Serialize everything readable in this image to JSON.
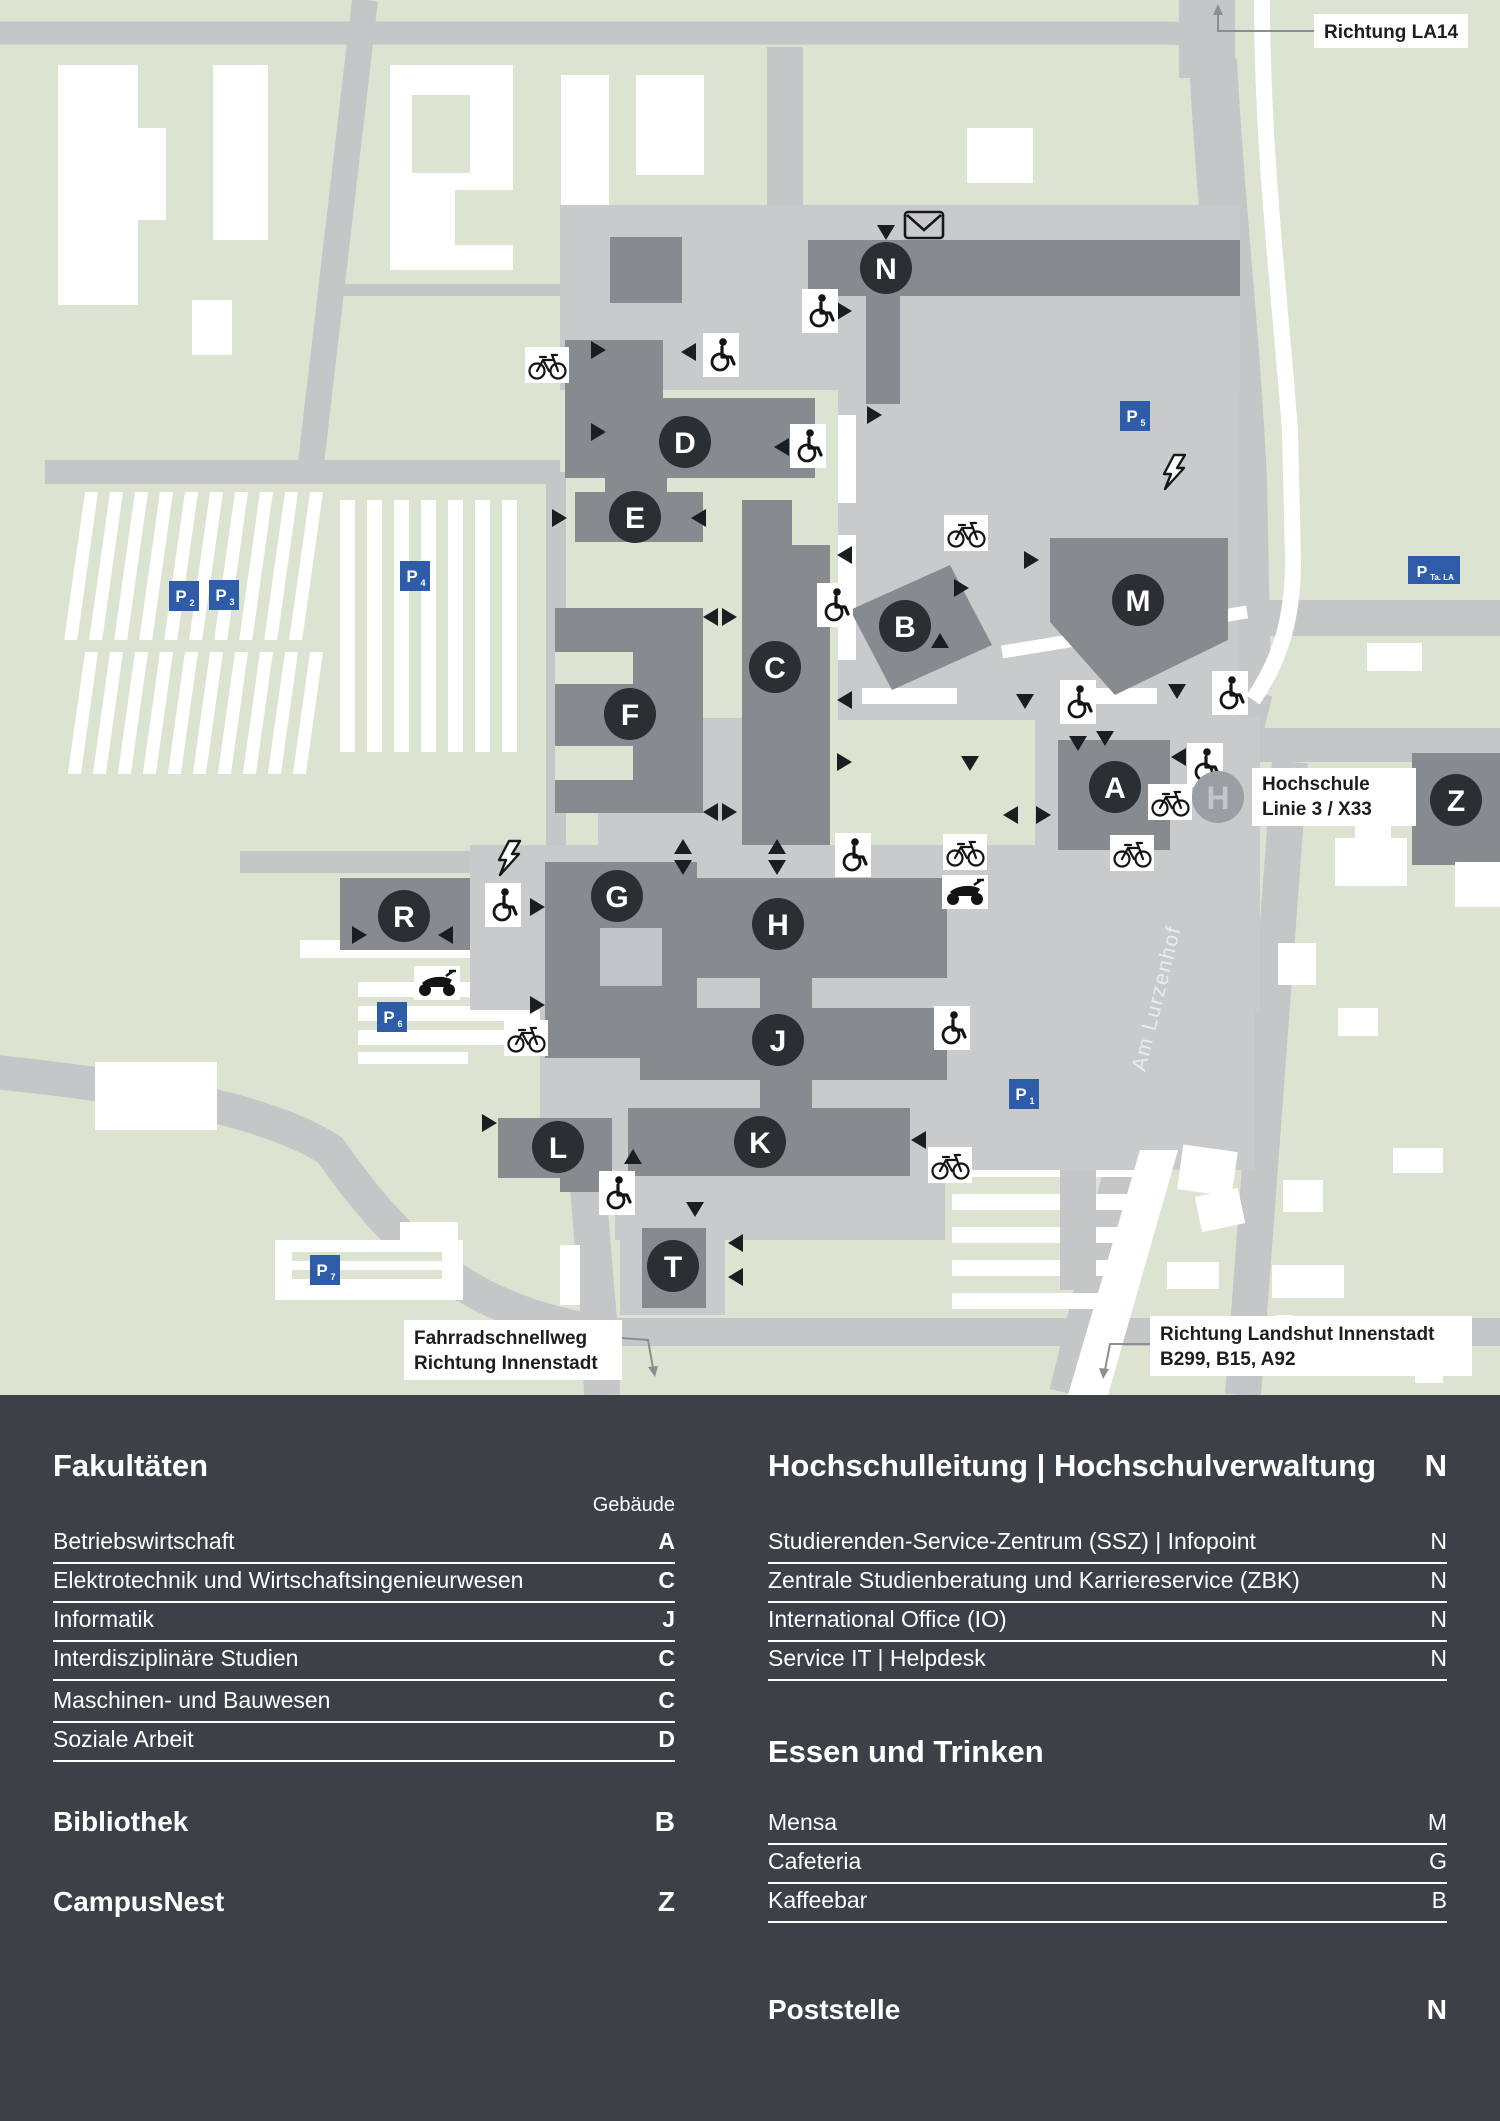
{
  "map": {
    "building_letters": [
      "N",
      "D",
      "E",
      "B",
      "C",
      "F",
      "M",
      "A",
      "Z",
      "R",
      "G",
      "H",
      "J",
      "K",
      "L",
      "T"
    ],
    "parking_signs": [
      {
        "p": "P",
        "sub": "1"
      },
      {
        "p": "P",
        "sub": "2"
      },
      {
        "p": "P",
        "sub": "3"
      },
      {
        "p": "P",
        "sub": "4"
      },
      {
        "p": "P",
        "sub": "5"
      },
      {
        "p": "P",
        "sub": "6"
      },
      {
        "p": "P",
        "sub": "7"
      },
      {
        "p": "P",
        "sub": "Ta. LA"
      }
    ],
    "bus_stop": {
      "symbol": "H",
      "label_line1": "Hochschule",
      "label_line2": "Linie 3 / X33"
    },
    "labels": {
      "top_right": "Richtung LA14",
      "street": "Am Lurzenhof",
      "bottom_left_line1": "Fahrradschnellweg",
      "bottom_left_line2": "Richtung Innenstadt",
      "bottom_right_line1": "Richtung Landshut Innenstadt",
      "bottom_right_line2": "B299, B15, A92"
    }
  },
  "legend": {
    "left": {
      "title": "Fakultäten",
      "column_note": "Gebäude",
      "rows": [
        {
          "label": "Betriebswirtschaft",
          "code": "A"
        },
        {
          "label": "Elektrotechnik und Wirtschaftsingenieurwesen",
          "code": "C"
        },
        {
          "label": "Informatik",
          "code": "J"
        },
        {
          "label": "Interdisziplinäre Studien",
          "code": "C"
        },
        {
          "label": "Maschinen- und Bauwesen",
          "code": "C"
        },
        {
          "label": "Soziale Arbeit",
          "code": "D"
        }
      ],
      "extra_sections": [
        {
          "title": "Bibliothek",
          "code": "B"
        },
        {
          "title": "CampusNest",
          "code": "Z"
        }
      ]
    },
    "right": {
      "sections": [
        {
          "title": "Hochschulleitung | Hochschulverwaltung",
          "code": "N",
          "rows": [
            {
              "label": "Studierenden-Service-Zentrum (SSZ) | Infopoint",
              "code": "N"
            },
            {
              "label": "Zentrale Studienberatung und Karriereservice (ZBK)",
              "code": "N"
            },
            {
              "label": "International Office (IO)",
              "code": "N"
            },
            {
              "label": "Service IT | Helpdesk",
              "code": "N"
            }
          ]
        },
        {
          "title": "Essen und Trinken",
          "code": "",
          "rows": [
            {
              "label": "Mensa",
              "code": "M"
            },
            {
              "label": "Cafeteria",
              "code": "G"
            },
            {
              "label": "Kaffeebar",
              "code": "B"
            }
          ]
        },
        {
          "title": "Poststelle",
          "code": "N",
          "rows": []
        }
      ]
    }
  },
  "colors": {
    "green": "#dce3d0",
    "road": "#c5c6c8",
    "plaza": "#c9cacc",
    "building": "#878b90",
    "badge": "#2a2f34",
    "footer": "#3c4147",
    "parking_blue": "#2e5ca9",
    "white": "#ffffff",
    "bus_circle": "#9b9ea2"
  }
}
